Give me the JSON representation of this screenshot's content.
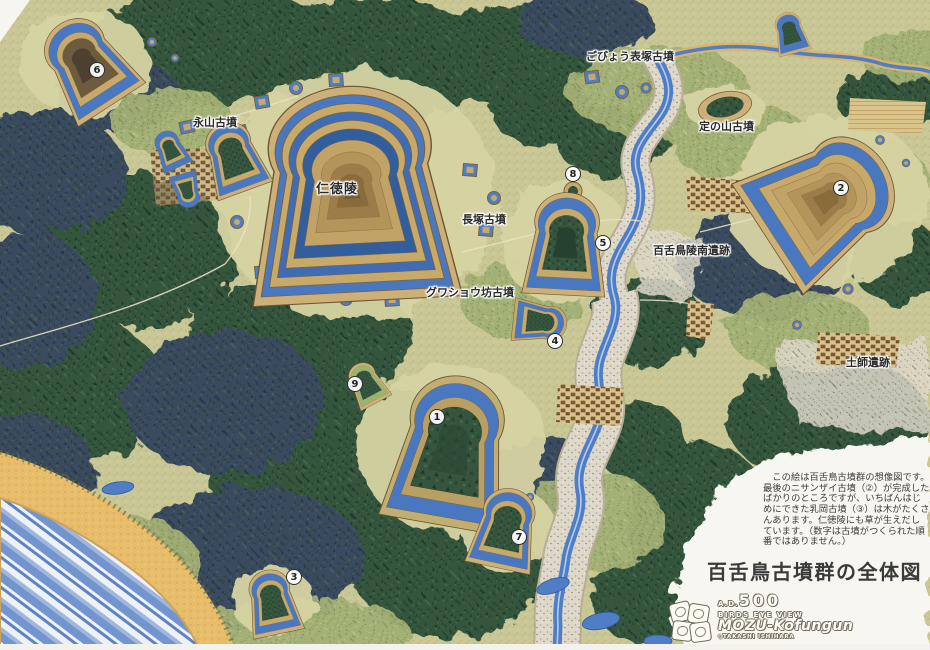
{
  "title": "百舌鳥古墳群の全体図",
  "labels": {
    "nagayama": "永山古墳",
    "nintoku": "仁徳陵",
    "gobyo_omotezuka": "ごびょう表塚古墳",
    "jonoyama": "定の山古墳",
    "nagatsuka": "長塚古墳",
    "mozu_ryonan": "百舌鳥陵南遺跡",
    "gwashobo": "グワショウ坊古墳",
    "haze": "土師遺跡"
  },
  "markers": {
    "m1": "1",
    "m2": "2",
    "m3": "3",
    "m4": "4",
    "m5": "5",
    "m6": "6",
    "m7": "7",
    "m8": "8",
    "m9": "9"
  },
  "legend": {
    "lines": [
      "　この絵は百舌鳥古墳群の想像図です。",
      "最後のニサンザイ古墳（②）が完成した",
      "ばかりのところですが、いちばんはじ",
      "めにできた乳岡古墳（③）は木がたくさ",
      "んあります。仁徳陵にも草が生えだし",
      "ています。（数字は古墳がつくられた順",
      "番ではありません。）"
    ]
  },
  "logo": {
    "era_prefix": "A.D.",
    "era_number": "500",
    "line1": "BIRDS EYE VIEW",
    "line2": "MOZU-Kofungun",
    "credit": "◇TAKASHI ISHIHARA"
  },
  "colors": {
    "moat_blue": "#4a78c0",
    "bank_tan": "#c7a96a",
    "forest_green": "#35553e",
    "conifer_navy": "#3a4c5e",
    "meadow": "#c8c795",
    "river_water": "#4f7dc6",
    "riverbed": "#ddd8c9",
    "sea_blue": "#6f94d2",
    "beach_sand": "#e7bd6a",
    "paper_white": "#f6f5ef"
  }
}
